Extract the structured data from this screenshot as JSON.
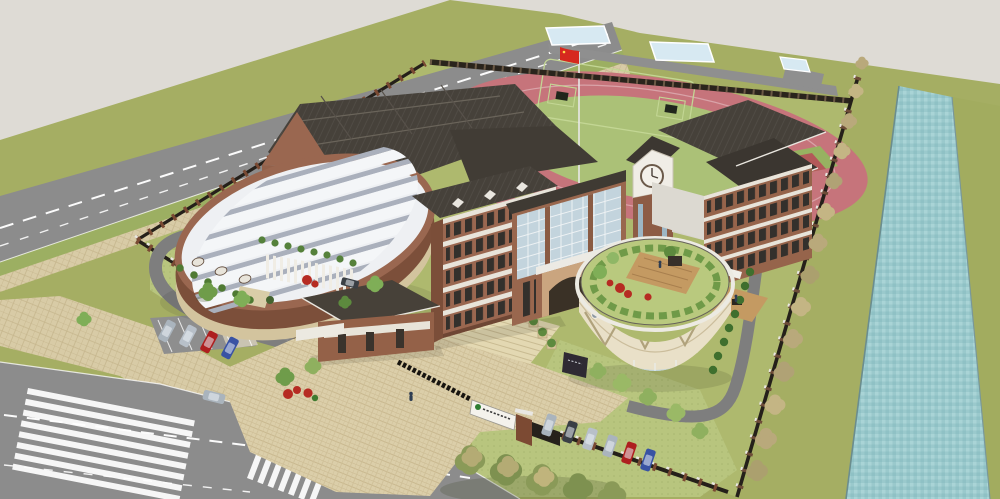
{
  "render": {
    "width": 1000,
    "height": 499,
    "type": "aerial-3d-architectural-rendering",
    "subject": "school campus with running track, canal and perimeter roads"
  },
  "colors": {
    "bg": "#dedbd5",
    "grassOuter": "#a5ae63",
    "grassSite": "#aeb96e",
    "lawnLight": "#b8c57e",
    "road": "#8c8c8c",
    "roadInner": "#7e7e7e",
    "sidewalk": "#d8cba6",
    "plaza": "#dbcea9",
    "track": "#c6747b",
    "infield": "#abc177",
    "courtRed": "#b35959",
    "water": "#9ac9cc",
    "brick": "#9a6750",
    "brickDark": "#7c4f3a",
    "roofDark": "#46413a",
    "trimWhite": "#e9e6df",
    "skylight": "#eef0f3",
    "glass": "#c3d4dd",
    "fenceDark": "#25201a",
    "postBrick": "#7a4a33",
    "treeGreen": "#6f9c4a",
    "treeLight": "#8fb05f",
    "shrub": "#55813b",
    "treeAutumn": "#b9a97b",
    "flowerRed": "#b62b22",
    "flagRed": "#d6281e",
    "carSilver": "#aab4bd",
    "carRed": "#ae1f1f",
    "carBlue": "#3953a4",
    "carDark": "#3a3f45",
    "deckWood": "#c49a62",
    "clockFace": "#f4f1ea",
    "signGreen": "#2e7d32",
    "pond": "#d7e9f2"
  },
  "scene": {
    "flag": "china-flag-on-white-pole",
    "track": {
      "shape": "oval",
      "goals": 2,
      "flower_pads": 2,
      "basketball_court": 1
    },
    "vehicles": {
      "west_parking": [
        "silver",
        "silver",
        "red",
        "blue"
      ],
      "south_fence_row": [
        "silver",
        "dark",
        "silver",
        "silver",
        "red",
        "blue"
      ],
      "on_road": [
        "silver"
      ],
      "courtyard": [
        "dark"
      ]
    },
    "crossings": {
      "zebra_count": 2
    },
    "gate_sign": {
      "logo": "green-circle",
      "text_legible": false
    },
    "buildings": [
      "workshop-hall",
      "oval-gymnasium",
      "classroom-block",
      "main-entrance-building",
      "clock-tower",
      "dormitory-wing",
      "cylindrical-roof-garden-building",
      "gatehouse"
    ],
    "landscape": [
      "canal",
      "autumn-tree-row",
      "green-trees",
      "shrub-rows",
      "red-flower-bushes",
      "roof-garden",
      "ponds"
    ]
  }
}
